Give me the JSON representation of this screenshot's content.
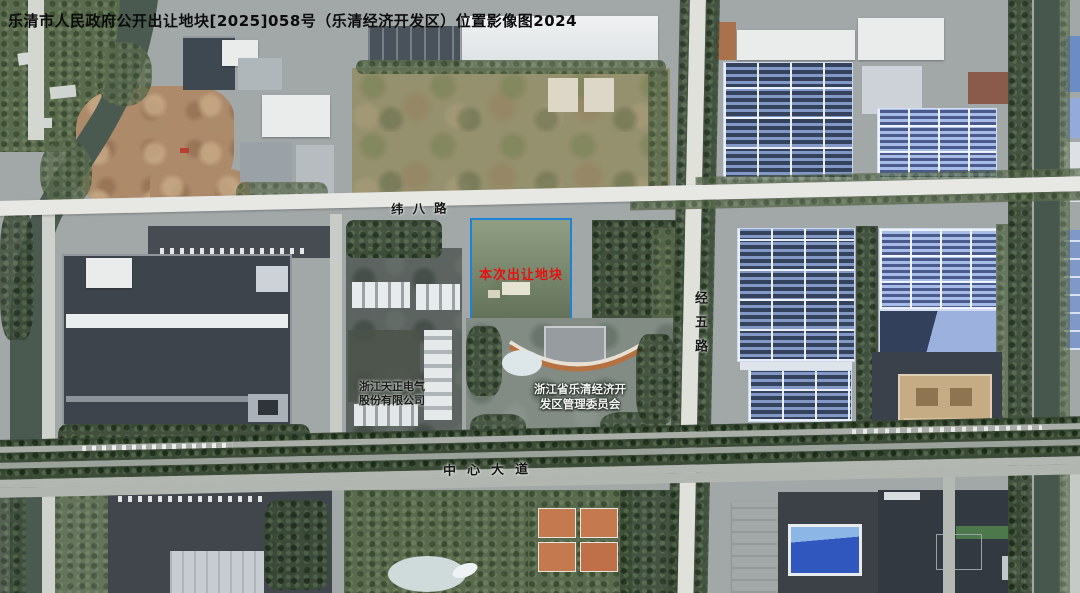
{
  "map": {
    "title": "乐清市人民政府公开出让地块[2025]058号（乐清经济开发区）位置影像图2024",
    "parcel_label": "本次出让地块",
    "roads": {
      "weiba": "纬八路",
      "jingwu": "经五路",
      "zhongxin": "中心大道"
    },
    "landmarks": {
      "tianzheng_line1": "浙江天正电气",
      "tianzheng_line2": "股份有限公司",
      "guanweihui_line1": "浙江省乐清经济开",
      "guanweihui_line2": "发区管理委员会"
    },
    "colors": {
      "parcel_outline": "#1e82d6",
      "parcel_label_red": "#e8100e",
      "title_black": "#0c0c0c",
      "water_green": "#4a5a51",
      "solar_panel_blue": "#7d95c8",
      "road_light": "#e6e7e3",
      "avenue_tree_green": "#3c4b37",
      "construction_brown": "#ac8a6a"
    }
  }
}
